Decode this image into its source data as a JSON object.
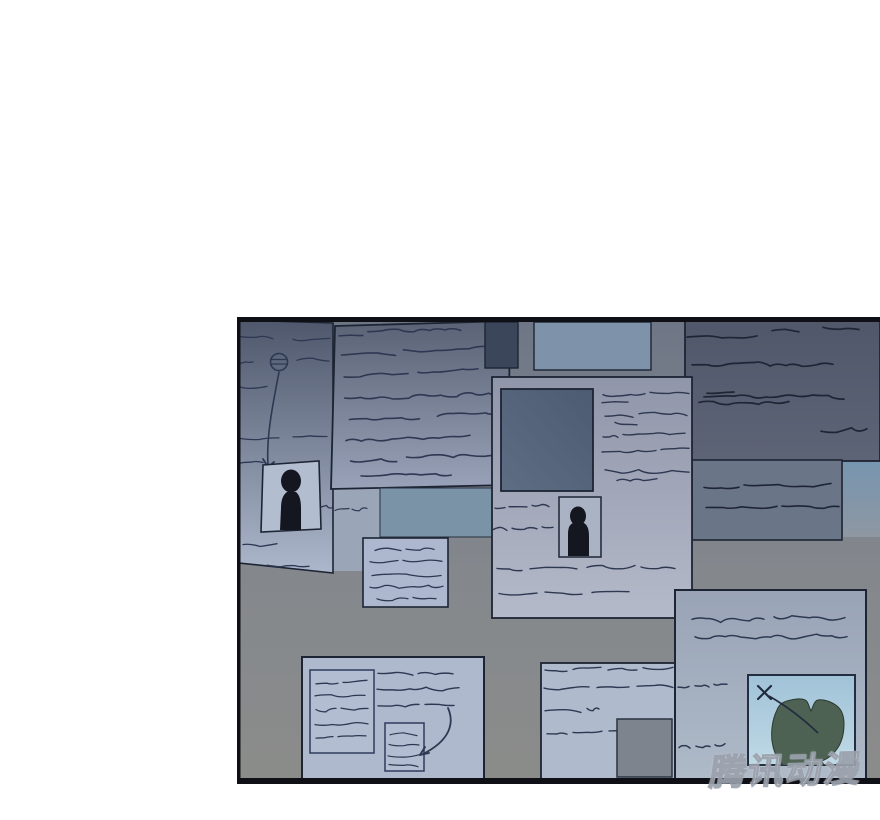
{
  "watermark": {
    "text": "腾讯动漫"
  },
  "palette": {
    "wall-top": "#6e7686",
    "wall-mid": "#84888d",
    "wall-bot": "#8b8c8a",
    "border": "#0e1016",
    "stroke": "#1d2534",
    "ink": "#2e3852",
    "ink-dk": "#1e2535",
    "left-top": "#4e576b",
    "left-bot": "#adb7cc",
    "tilt-top": "#5a6275",
    "tilt-bot": "#99a2b8",
    "dark-rect": "#3b465b",
    "blue-rect": "#7e93aa",
    "blue-teal": "#7a93a6",
    "lite-sheet": "#9aa5b8",
    "poster-top": "#9096a9",
    "poster-bot": "#b4bac9",
    "pdark-top": "#4c5b72",
    "pdark-bot": "#5e6d83",
    "photo1": "#b3bdd0",
    "photo2": "#a9b3c4",
    "sil": "#14171f",
    "tr-top": "#50576a",
    "tr-bot": "#5d6476",
    "rm": "#6b7588",
    "patch-top": "#7796b0",
    "patch-bot": "#8e97a2",
    "note": "#adb8ce",
    "bl": "#aeb9cd",
    "inner-note": "#b2bdd1",
    "bm": "#b0bacd",
    "gray-sq": "#7d848d",
    "mapposter-top": "#99a3b6",
    "mapposter-bot": "#aebac8",
    "map-top": "#a0c2d8",
    "map-bot": "#bfd9e5",
    "island": "#4d6253",
    "island-edge": "#2c3830",
    "wm-fill": "#ffffff",
    "wm-stroke": "#9ba1ac"
  }
}
